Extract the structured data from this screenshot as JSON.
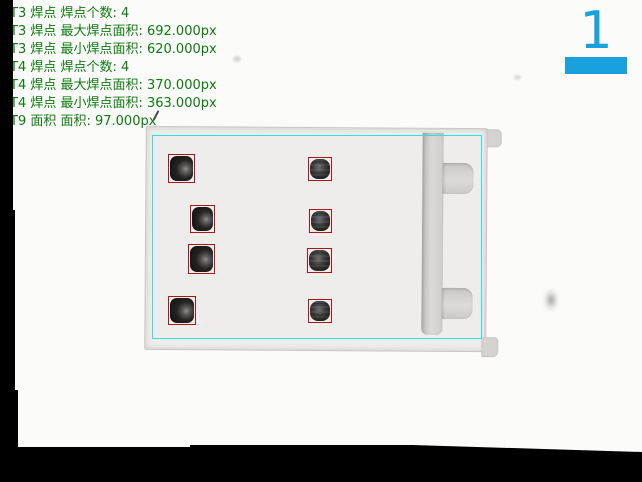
{
  "colors": {
    "accent": "#18a1dc",
    "roi": "#2ae2e2",
    "detection": "#a81717",
    "result-text": "#0d7a0f"
  },
  "results_panel": {
    "lines": [
      "T3 焊点 焊点个数: 4",
      "T3 焊点 最大焊点面积: 692.000px",
      "T3 焊点 最小焊点面积: 620.000px",
      "T4 焊点 焊点个数: 4",
      "T4 焊点 最大焊点面积: 370.000px",
      "T4 焊点 最小焊点面积: 363.000px",
      "T9 面积 面积: 97.000px"
    ]
  },
  "step_indicator": {
    "number": "1"
  },
  "inspection": {
    "t3": {
      "count": 4,
      "max_area_px": 692.0,
      "min_area_px": 620.0
    },
    "t4": {
      "count": 4,
      "max_area_px": 370.0,
      "min_area_px": 363.0
    },
    "t9": {
      "area_px": 97.0
    },
    "detection_boxes": 8
  }
}
